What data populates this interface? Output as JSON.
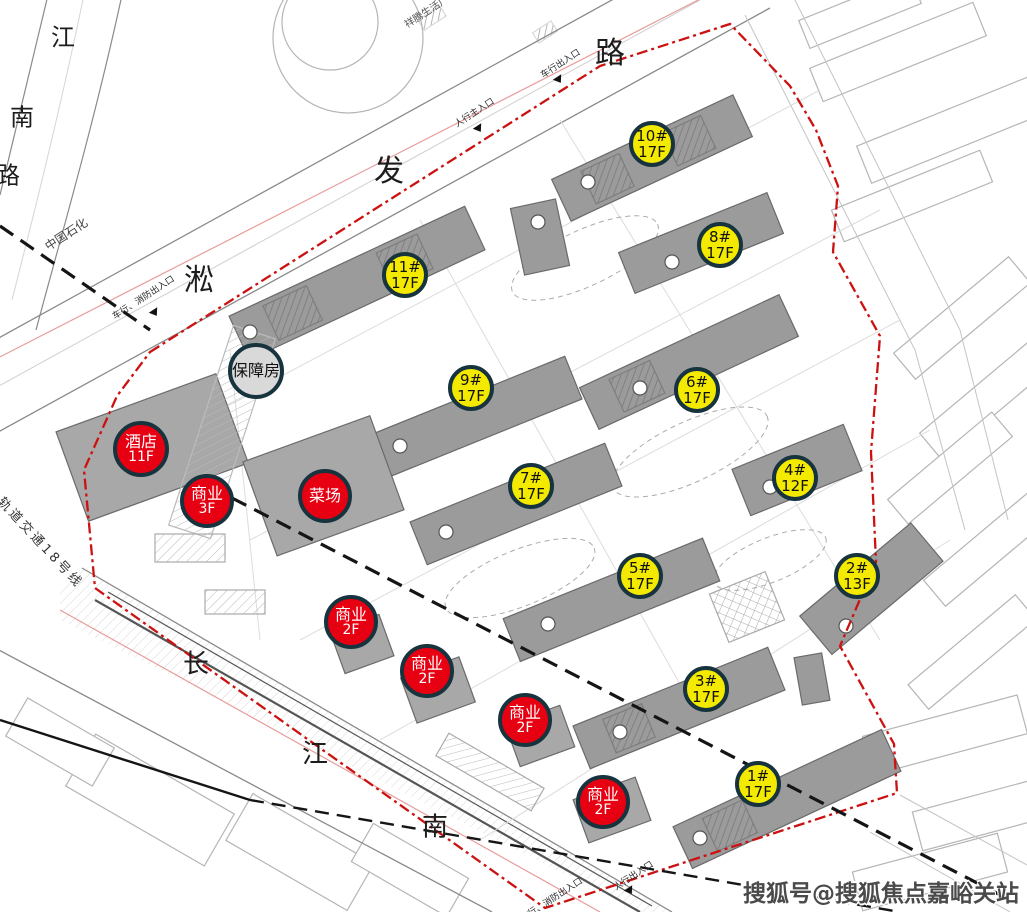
{
  "roads": {
    "jiangnan_road": {
      "name": "江南路",
      "chars": [
        "江",
        "南",
        "路"
      ]
    },
    "songfa_road": {
      "name": "淞发路",
      "chars": [
        "淞",
        "发",
        "路"
      ]
    },
    "changjiang_south_road": {
      "name": "长江南",
      "chars": [
        "长",
        "江",
        "南"
      ]
    },
    "metro_line_label": "轨道交通18号线"
  },
  "labels": {
    "sinopec": "中国石化",
    "plaza_north": "祥腾生活广场",
    "entrance_vehicle_top": "车行出入口",
    "entrance_main_pedestrian": "人行主入口",
    "entrance_vehicle_fire_west": "车行、消防出入口",
    "entrance_pedestrian_south": "人行出入口",
    "entrance_vehicle_fire_south": "车行、消防出入口"
  },
  "markers": {
    "residential": [
      {
        "name": "10#",
        "floors": "17F"
      },
      {
        "name": "8#",
        "floors": "17F"
      },
      {
        "name": "11#",
        "floors": "17F"
      },
      {
        "name": "9#",
        "floors": "17F"
      },
      {
        "name": "6#",
        "floors": "17F"
      },
      {
        "name": "7#",
        "floors": "17F"
      },
      {
        "name": "4#",
        "floors": "12F"
      },
      {
        "name": "5#",
        "floors": "17F"
      },
      {
        "name": "2#",
        "floors": "13F"
      },
      {
        "name": "3#",
        "floors": "17F"
      },
      {
        "name": "1#",
        "floors": "17F"
      }
    ],
    "commercial": [
      {
        "name": "酒店",
        "floors": "11F"
      },
      {
        "name": "商业",
        "floors": "3F"
      },
      {
        "name": "菜场",
        "floors": ""
      },
      {
        "name": "商业",
        "floors": "2F"
      },
      {
        "name": "商业",
        "floors": "2F"
      },
      {
        "name": "商业",
        "floors": "2F"
      },
      {
        "name": "商业",
        "floors": "2F"
      }
    ],
    "support": {
      "name": "保障房"
    }
  },
  "watermark": "搜狐号@搜狐焦点嘉峪关站",
  "colors": {
    "residential_marker": "#f3ea00",
    "commercial_marker": "#e60012",
    "support_marker": "#d9d9d9",
    "marker_outline": "#17333e",
    "site_boundary": "#cc1111",
    "building_fill": "#9b9b9b"
  }
}
